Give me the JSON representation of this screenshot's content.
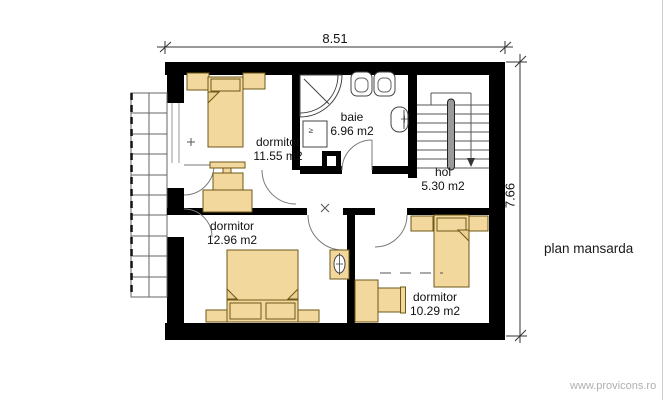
{
  "page": {
    "title_label": "plan mansarda",
    "watermark": "www.provicons.ro"
  },
  "dimensions": {
    "width": "8.51",
    "height": "7.66"
  },
  "rooms": [
    {
      "name": "dormitor",
      "area": "11.55 m2"
    },
    {
      "name": "baie",
      "area": "6.96 m2"
    },
    {
      "name": "hol",
      "area": "5.30 m2"
    },
    {
      "name": "dormitor",
      "area": "12.96 m2"
    },
    {
      "name": "dormitor",
      "area": "10.29 m2"
    }
  ],
  "symbols": {
    "washer_glyph": "≥"
  },
  "colors": {
    "wall": "#000000",
    "furniture_fill": "#f3d89e",
    "furniture_stroke": "#6d5716",
    "watermark": "#b0b0b0"
  }
}
